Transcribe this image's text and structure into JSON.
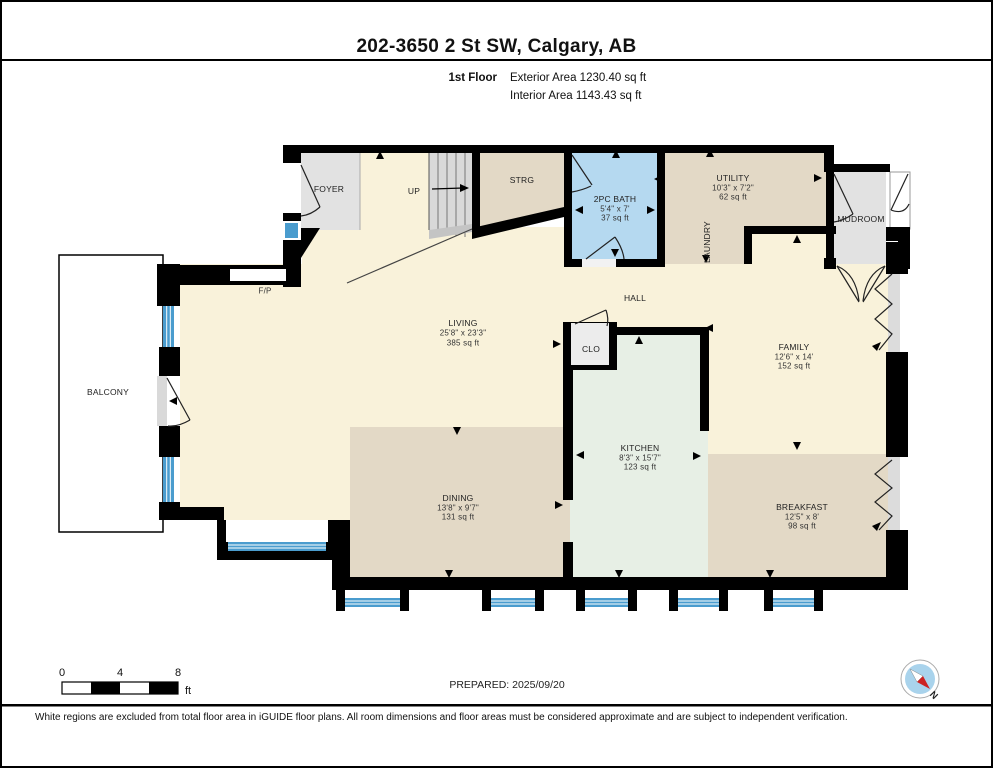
{
  "header": {
    "title": "202-3650 2 St SW, Calgary, AB",
    "floor_label": "1st Floor",
    "exterior_area": "Exterior Area 1230.40 sq ft",
    "interior_area": "Interior Area 1143.43 sq ft"
  },
  "rooms": {
    "foyer": {
      "name": "FOYER"
    },
    "stairs": {
      "direction_label": "UP"
    },
    "strg": {
      "name": "STRG"
    },
    "bath": {
      "name": "2PC BATH",
      "dims": "5'4\" x 7'",
      "area": "37 sq ft"
    },
    "utility": {
      "name": "UTILITY",
      "dims": "10'3\" x 7'2\"",
      "area": "62 sq ft"
    },
    "laundry": {
      "name": "LAUNDRY"
    },
    "mudroom": {
      "name": "MUDROOM"
    },
    "hall": {
      "name": "HALL"
    },
    "clo": {
      "name": "CLO"
    },
    "living": {
      "name": "LIVING",
      "dims": "25'8\" x 23'3\"",
      "area": "385 sq ft"
    },
    "family": {
      "name": "FAMILY",
      "dims": "12'6\" x 14'",
      "area": "152 sq ft"
    },
    "kitchen": {
      "name": "KITCHEN",
      "dims": "8'3\" x 15'7\"",
      "area": "123 sq ft"
    },
    "dining": {
      "name": "DINING",
      "dims": "13'8\" x 9'7\"",
      "area": "131 sq ft"
    },
    "breakfast": {
      "name": "BREAKFAST",
      "dims": "12'5\" x 8'",
      "area": "98 sq ft"
    },
    "balcony": {
      "name": "BALCONY"
    },
    "fireplace": {
      "name": "F/P"
    }
  },
  "footer": {
    "scale": {
      "start": "0",
      "mid": "4",
      "end": "8",
      "unit": "ft"
    },
    "prepared": "PREPARED: 2025/09/20",
    "compass_n": "N",
    "disclaimer": "White regions are excluded from total floor area in iGUIDE floor plans. All room dimensions and floor areas must be considered approximate and are subject to independent verification."
  },
  "colors": {
    "wall": "#000000",
    "floor_main": "#f9f2da",
    "floor_tan": "#e3d9c6",
    "floor_bath": "#b5d9f0",
    "floor_kitchen": "#e7efe5",
    "floor_gray": "#e2e2e2",
    "window_blue": "#4a9cce",
    "compass_fill": "#a9d3ec",
    "compass_needle_red": "#cc2222"
  }
}
